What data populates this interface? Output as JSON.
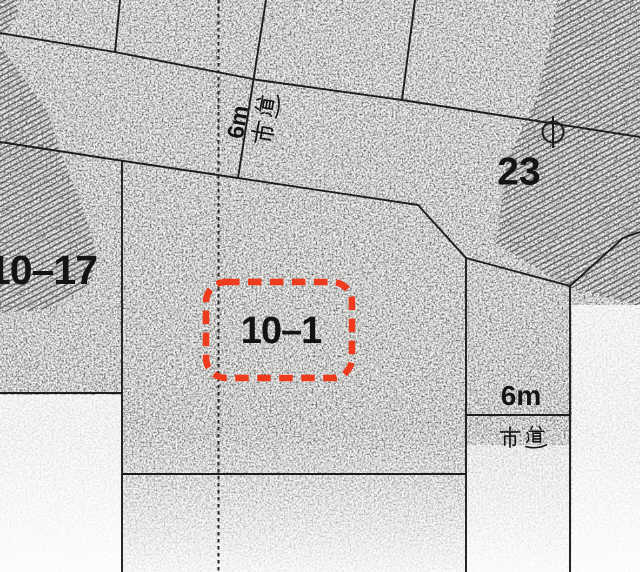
{
  "map": {
    "title": "cadastral-parcel-map",
    "parcels": [
      {
        "id": "10-1",
        "label": "10–1",
        "highlighted": true,
        "highlight_style": "red-dashed-rounded-rectangle"
      },
      {
        "id": "10-17",
        "label": "10–17",
        "highlighted": false
      },
      {
        "id": "23",
        "label": "23",
        "highlighted": false,
        "texture": "diagonal-hatch"
      }
    ],
    "roads": [
      {
        "position": "upper-diagonal",
        "width_label": "6m",
        "name_label": "市道",
        "label_orientation": "rotated-along-boundary"
      },
      {
        "position": "right-vertical",
        "width_label": "6m",
        "name_label": "市道",
        "label_orientation": "horizontal"
      }
    ],
    "symbols": [
      {
        "name": "survey-marker",
        "shape": "circle-with-vertical-line",
        "x": 553,
        "y": 132
      }
    ],
    "colors": {
      "highlight_red": "#ee3a1d",
      "line_black": "#1c1c1c",
      "hatch_gray": "#3f3f3f",
      "paper_white": "#fdfdfc"
    }
  }
}
